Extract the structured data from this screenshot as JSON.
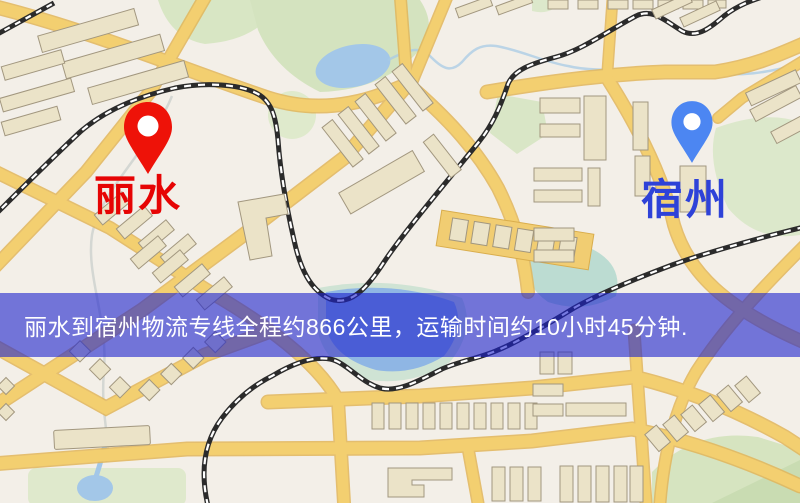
{
  "origin": {
    "label": "丽水",
    "label_color": "#e60404",
    "pin_color": "#ee1208"
  },
  "destination": {
    "label": "宿州",
    "label_color": "#2e42d8",
    "pin_color": "#4c86f2"
  },
  "banner": {
    "text": "丽水到宿州物流专线全程约866公里，运输时间约10小时45分钟.",
    "bg_rgba": "rgba(28,34,205,0.60)",
    "text_color": "#ffffff"
  },
  "route": {
    "from": "丽水",
    "to": "宿州",
    "distance_text": "约866公里",
    "duration_text": "约10小时45分钟"
  },
  "map_colors": {
    "background": "#f3efe8",
    "road_fill": "#f3cf70",
    "road_casing": "#e2b65a",
    "building_fill": "#ebe3c8",
    "building_outline": "#a2977f",
    "park": "#d8e6c4",
    "water": "#a3c7e8",
    "lake_fringe": "#cfe3d4",
    "teal_water": "#bcdcd2",
    "railway": "#2b2b2b"
  }
}
